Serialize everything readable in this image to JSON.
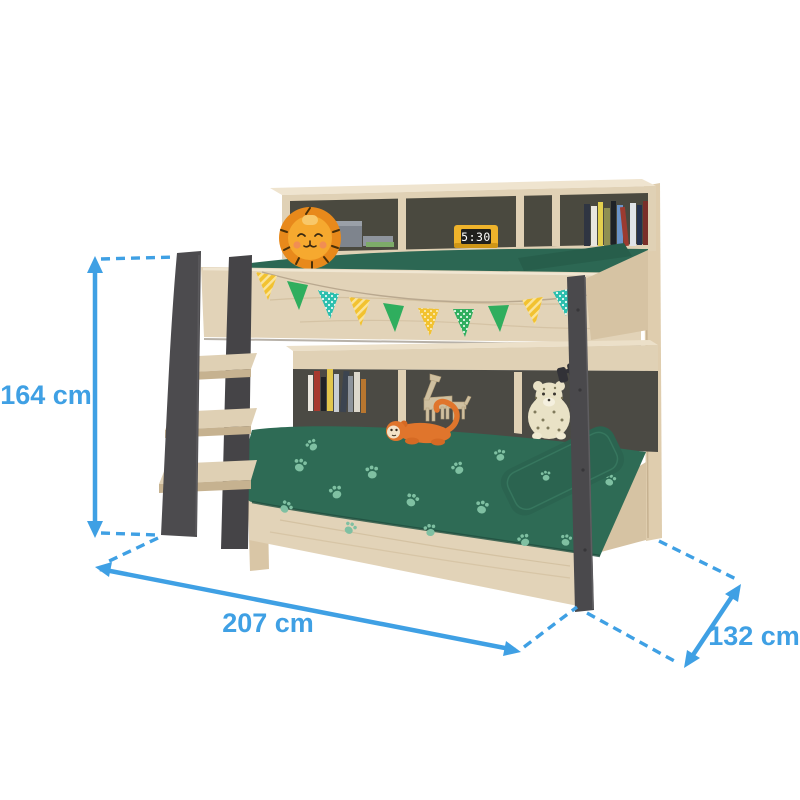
{
  "measurements": {
    "height": {
      "value": 164,
      "unit": "cm",
      "label": "164 cm"
    },
    "length": {
      "value": 207,
      "unit": "cm",
      "label": "207 cm"
    },
    "depth": {
      "value": 132,
      "unit": "cm",
      "label": "132 cm"
    }
  },
  "clock": {
    "time": "5:30"
  },
  "colors": {
    "dimension_blue": "#3fa0e4",
    "wood_light": "#e2d3b8",
    "wood_mid": "#d6c3a3",
    "wood_shadow": "#c9b592",
    "frame_gray": "#4c4b4e",
    "shelf_back_gray": "#4a493f",
    "bedding_green": "#2e6b55",
    "pillow_green": "#2b6450",
    "paw_print_green": "#7fc0a2",
    "flag_yellow": "#f2c230",
    "flag_green": "#2fae5e",
    "flag_teal": "#2bbfae",
    "lion_orange": "#e8891b",
    "clock_yellow": "#efb32b"
  },
  "decor_items": [
    "lion-plush",
    "storage-box",
    "digital-clock",
    "book-spines",
    "bunting-flags",
    "toy-giraffe",
    "monkey-plush",
    "leopard-plush",
    "binoculars",
    "paw-print-bedding"
  ]
}
